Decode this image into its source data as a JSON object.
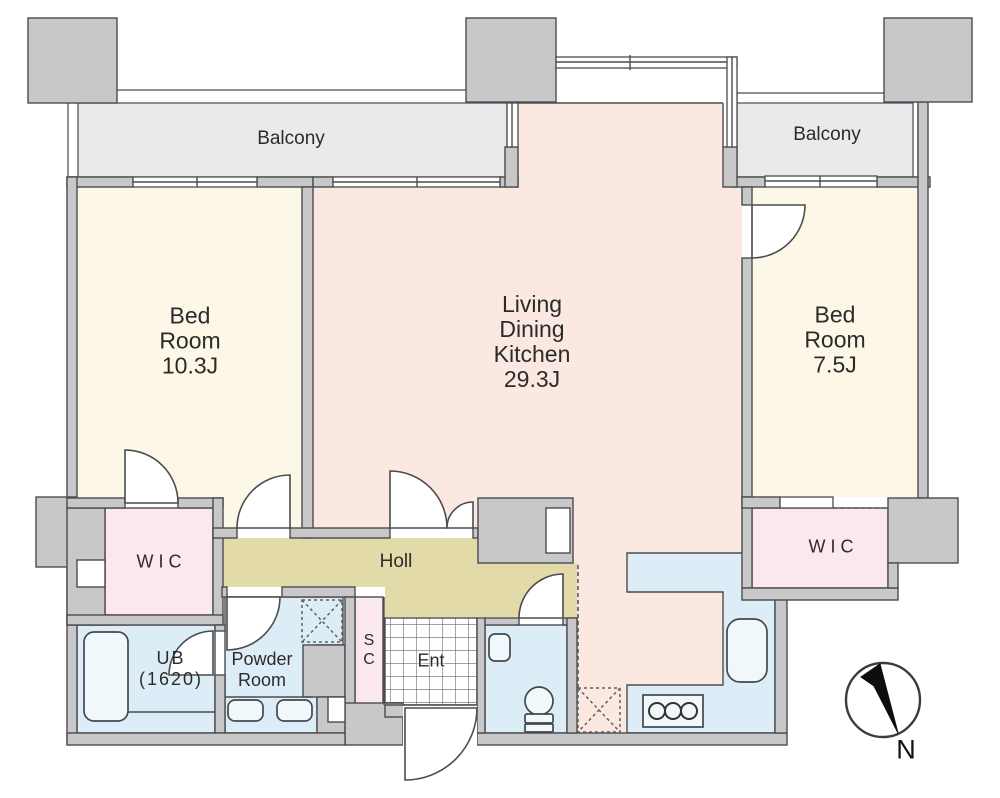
{
  "floorplan": {
    "balcony_left": "Balcony",
    "balcony_right": "Balcony",
    "bedroom_left": "Bed\nRoom\n10.3J",
    "ldk": "Living\nDining\nKitchen\n29.3J",
    "bedroom_right": "Bed\nRoom\n7.5J",
    "wic_left": "WIC",
    "wic_right": "WIC",
    "hall": "Holl",
    "unit_bath": "UB\n(1620)",
    "powder_room": "Powder\nRoom",
    "shoe_closet": "S\nC",
    "entrance": "Ent",
    "compass_north": "N",
    "colors": {
      "wall": "#c8c8ca",
      "wall_outline": "#4c4c4e",
      "room_bedroom": "#fdf7e7",
      "room_ldk": "#fbe9e1",
      "room_wic": "#fae7ef",
      "room_hall": "#e3daa9",
      "room_wet": "#ddedf8",
      "balcony": "#e9eaec"
    }
  }
}
